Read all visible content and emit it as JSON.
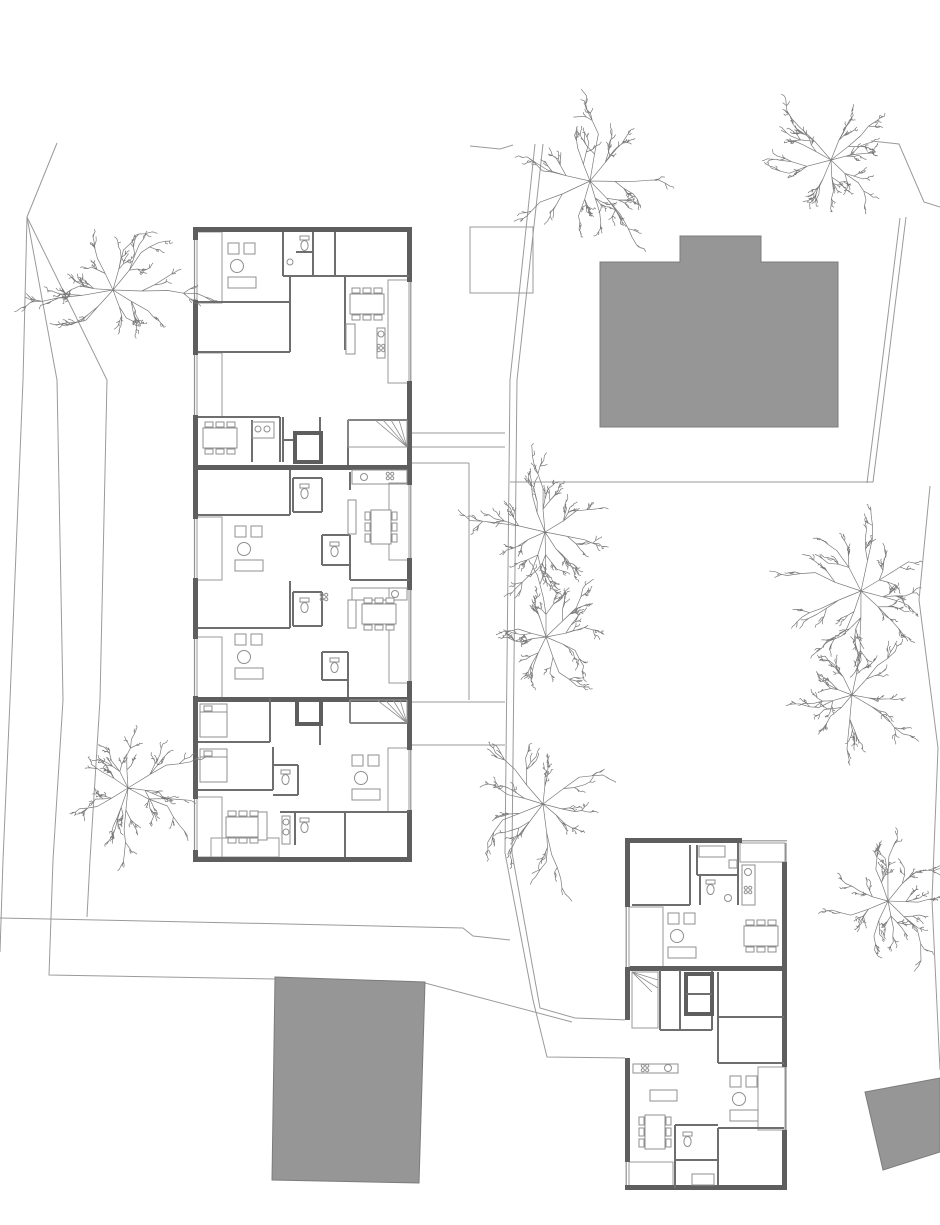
{
  "meta": {
    "drawing_type": "architectural-site-plan",
    "canvas": {
      "width": 940,
      "height": 1225
    },
    "background": "#ffffff"
  },
  "colors": {
    "wall": "#5e5e5e",
    "partition": "#6e6e6e",
    "furniture_line": "#8f8f8f",
    "hatch_line": "#9c9c9c",
    "site_line": "#9a9a9a",
    "tree_line": "#7a7a7a",
    "neighbor_fill": "#969696",
    "neighbor_stroke": "#7c7c7c"
  },
  "site": {
    "boundary_lines": [
      {
        "name": "west-road-line-1",
        "points": "57,143 27,217 23,380 10,700 3,860 0,952"
      },
      {
        "name": "west-road-line-2",
        "points": "27,217 57,380 63,700 53,860 49,975 275,979"
      },
      {
        "name": "west-road-line-3",
        "points": "27,217 107,380 100,700 90,860 87,917"
      },
      {
        "name": "south-boundary",
        "points": "0,918 287,924 463,928 473,936 510,940"
      },
      {
        "name": "southeast-connector",
        "points": "425,983 572,1022"
      },
      {
        "name": "northeast-boundary",
        "points": "871,141 899,144 924,202 940,207"
      },
      {
        "name": "east-boundary-upper",
        "points": "906,217 886,379 873,482"
      },
      {
        "name": "east-boundary-lower",
        "points": "930,486 919,600 938,748 932,900 940,1070"
      }
    ],
    "walkways": [
      {
        "name": "central-walkway-west-edge",
        "points": "535,144 510,380 505,853 533,1000 547,1057 628,1058"
      },
      {
        "name": "central-walkway-east-edge",
        "points": "543,144 517,380 512,853 540,1008 575,1018 628,1020"
      },
      {
        "name": "east-walkway-horizontal",
        "points": "510,482 873,482"
      },
      {
        "name": "east-walkway-inner",
        "points": "867,483 880,380 900,218"
      },
      {
        "name": "north-connector",
        "points": "470,146 500,149 513,145"
      }
    ]
  },
  "neighbor_buildings": [
    {
      "name": "neighbor-building-north",
      "points": "600,262 680,262 680,236 761,236 761,262 838,262 838,427 600,427"
    },
    {
      "name": "neighbor-building-south",
      "points": "275,977 425,982 419,1183 272,1180"
    },
    {
      "name": "neighbor-building-southeast",
      "points": "865,1092 940,1078 940,1152 883,1170"
    }
  ],
  "trees": [
    {
      "name": "tree-top-center",
      "cx": 590,
      "cy": 181,
      "r": 57,
      "seed": 11
    },
    {
      "name": "tree-top-right",
      "cx": 831,
      "cy": 160,
      "r": 46,
      "seed": 23
    },
    {
      "name": "tree-west-upper",
      "cx": 113,
      "cy": 290,
      "r": 55,
      "seed": 37
    },
    {
      "name": "tree-center-mid",
      "cx": 545,
      "cy": 532,
      "r": 52,
      "seed": 41
    },
    {
      "name": "tree-center-lower",
      "cx": 546,
      "cy": 637,
      "r": 43,
      "seed": 53
    },
    {
      "name": "tree-east-upper",
      "cx": 861,
      "cy": 591,
      "r": 55,
      "seed": 67
    },
    {
      "name": "tree-east-mid",
      "cx": 852,
      "cy": 695,
      "r": 46,
      "seed": 71
    },
    {
      "name": "tree-west-lower",
      "cx": 128,
      "cy": 788,
      "r": 46,
      "seed": 83
    },
    {
      "name": "tree-center-south",
      "cx": 543,
      "cy": 804,
      "r": 52,
      "seed": 89
    },
    {
      "name": "tree-east-south",
      "cx": 888,
      "cy": 901,
      "r": 47,
      "seed": 97
    }
  ],
  "buildings": [
    {
      "name": "apartment-building-west",
      "x": 193,
      "y": 227,
      "width": 219,
      "height": 635,
      "units": 3
    },
    {
      "name": "apartment-building-southeast",
      "x": 625,
      "y": 838,
      "width": 162,
      "height": 352,
      "units": 2
    }
  ]
}
